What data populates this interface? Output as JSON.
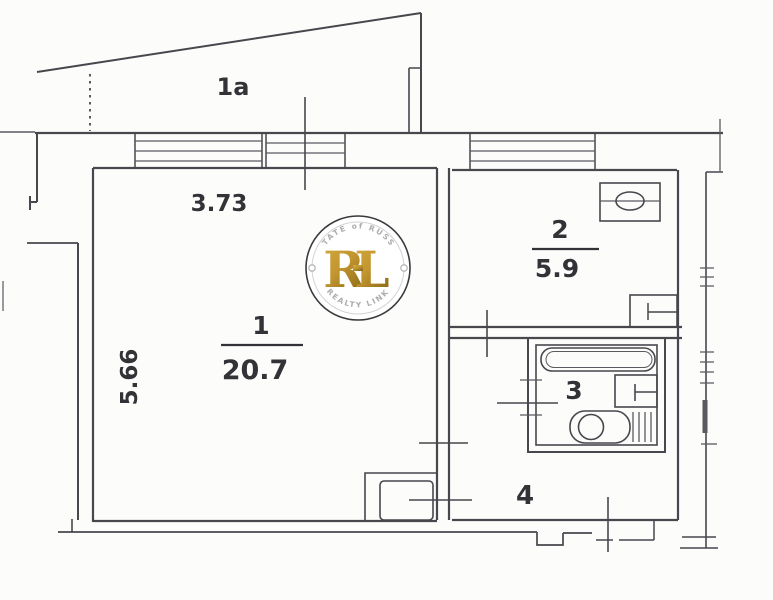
{
  "plan": {
    "balcony_label": "1a",
    "dim_width": "3.73",
    "dim_height": "5.66",
    "rooms": [
      {
        "number": "1",
        "area": "20.7"
      },
      {
        "number": "2",
        "area": "5.9"
      },
      {
        "number": "3"
      },
      {
        "number": "4"
      }
    ]
  },
  "watermark": {
    "arc_top": "ESTATE of RUSSIA",
    "letter_r": "R",
    "letter_l": "L",
    "arc_bottom": "REALTY LINK"
  },
  "colors": {
    "line": "#47474d",
    "label": "#323237",
    "gold_light": "#d4ab41",
    "gold_dark": "#8f6c17",
    "ring_text": "#acacac",
    "background": "#fcfcfb"
  }
}
